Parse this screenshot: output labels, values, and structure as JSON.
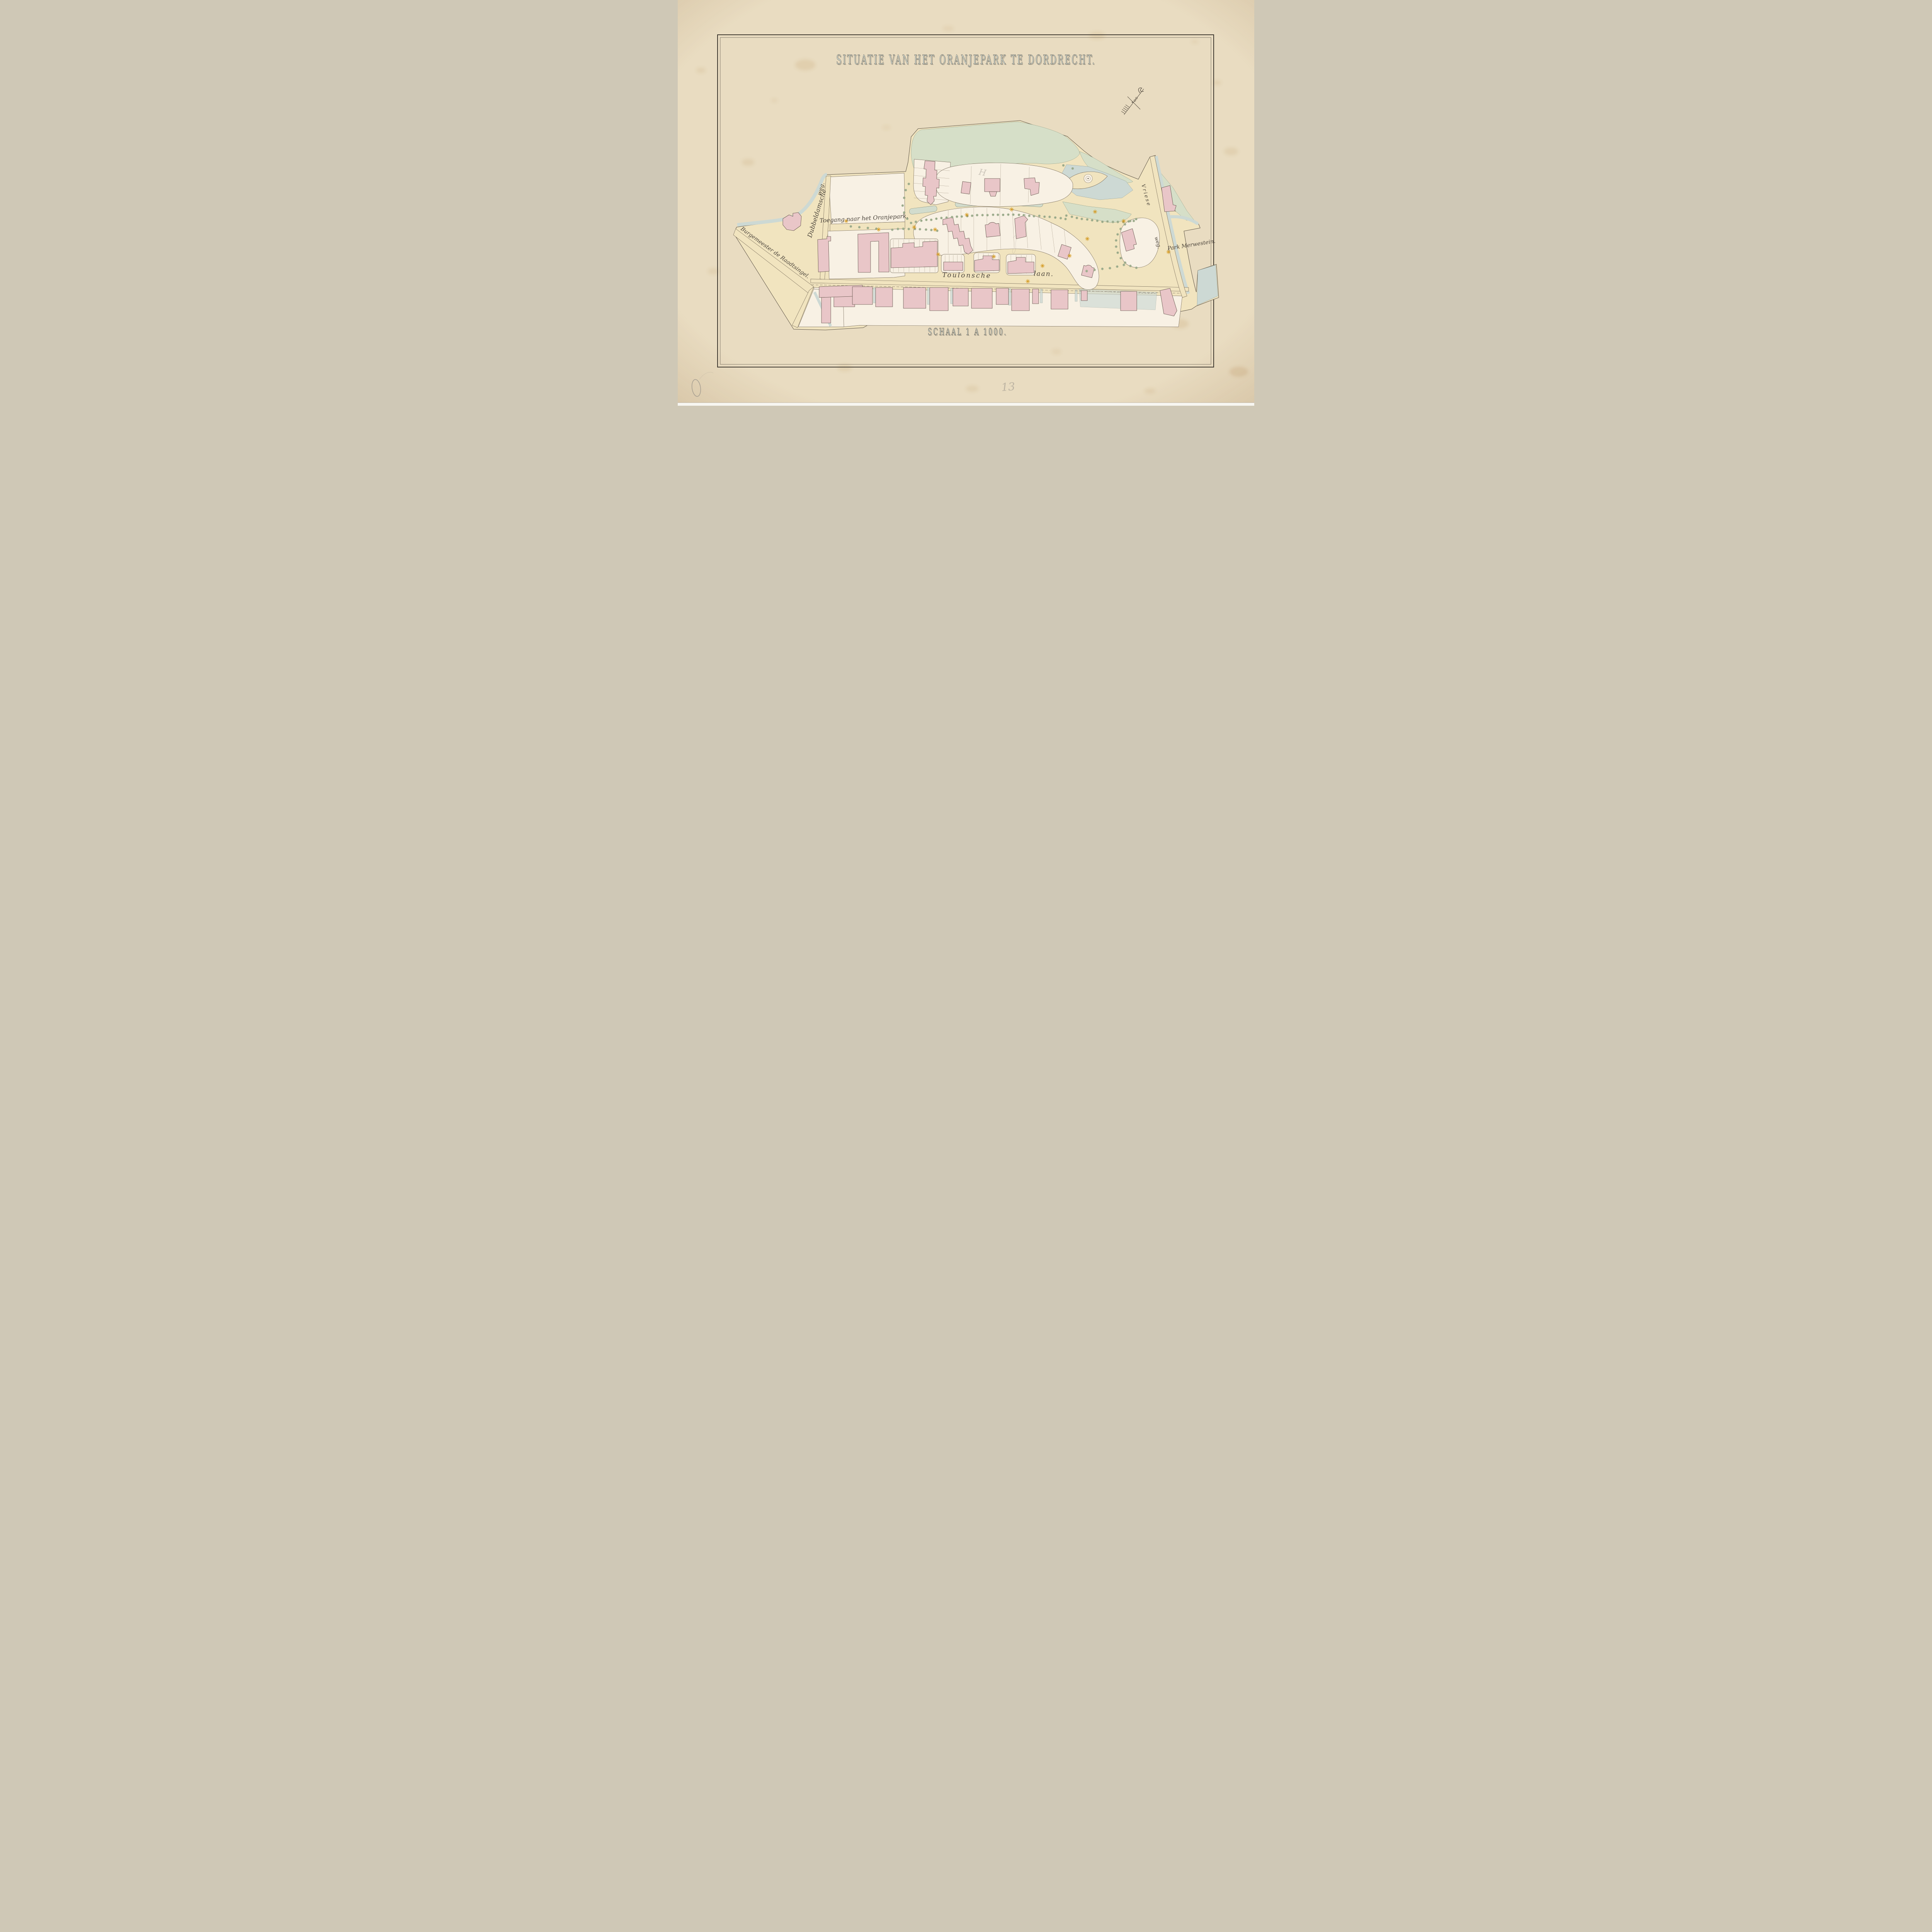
{
  "sheet": {
    "title": "SITUATIE VAN HET ORANJEPARK TE DORDRECHT.",
    "scale_label": "SCHAAL 1 A 1000."
  },
  "streets": {
    "toegang": "Toegang naar het Oranjepark.",
    "dubbeldamsche": "Dubbeldamsche",
    "dubbeldamsche_weg": "weg.",
    "burgemeester_de_raadtsingel": "Burgemeester de Raadtsingel.",
    "toulonsche": "Toulonsche",
    "laan": "laan.",
    "vriese": "Vriese",
    "vriese_weg": "weg.",
    "park_merwestein": "Park Merwestein."
  },
  "annotations": {
    "pencil_number": "13",
    "pencil_letter": "H"
  },
  "colors": {
    "paper": "#e9dcc1",
    "ink": "#4c443a",
    "road_cream": "#f1e4bf",
    "lot_white": "#f8f1e4",
    "building_pink": "#e9c6c8",
    "water_blue": "#cdd9d4",
    "park_green": "#d6dfc8",
    "hedge_green": "#d2dccd",
    "tree_green": "#b7c6a4",
    "star_orange": "#d49a22",
    "title_fill": "#d6e0d8",
    "pencil": "#9a948a"
  }
}
